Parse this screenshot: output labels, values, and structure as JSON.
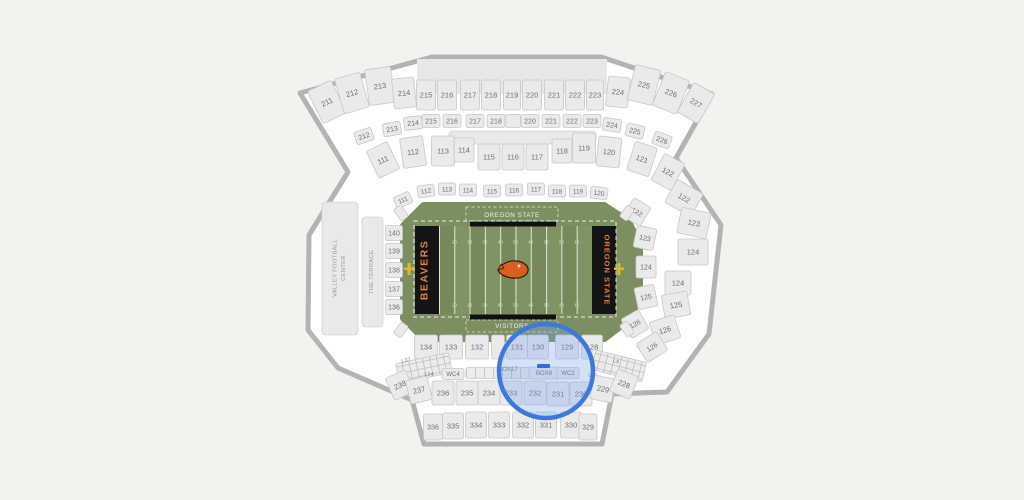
{
  "canvas": {
    "width": 1024,
    "height": 500
  },
  "colors": {
    "page_bg": "#f2f2ef",
    "bowl_bg": "#ffffff",
    "outline": "#b3b3b3",
    "section_fill": "#eaeaea",
    "section_stroke": "#c7c7c7",
    "section_text": "#6e6e6e",
    "structure_fill": "#e9e9e8",
    "apron_green": "#7b8f60",
    "field_green_dark": "#75895b",
    "field_green_light": "#7f9364",
    "endzone_black": "#141414",
    "osu_orange": "#e8813a",
    "logo_orange": "#d85f1d",
    "goalpost_yellow": "#dcb732",
    "highlight_stroke": "#3c78dd",
    "highlight_fill": "rgba(120,165,235,0.32)",
    "marker_blue": "#2e6fe0"
  },
  "field": {
    "sideline_home": "OREGON STATE",
    "sideline_visitors": "VISITORS",
    "endzone_west": "BEAVERS",
    "endzone_east": "OREGON STATE",
    "yard_numbers": [
      "10",
      "20",
      "30",
      "40",
      "50",
      "40",
      "30",
      "20",
      "10"
    ]
  },
  "venues": {
    "vfc_line1": "VALLEY FOOTBALL",
    "vfc_line2": "CENTER",
    "terrace": "THE TERRACE"
  },
  "highlight": {
    "cx": 546,
    "cy": 371,
    "r": 47,
    "stroke": "#3c78dd",
    "fill": "rgba(120,165,235,0.32)",
    "marker_fill": "#2e6fe0"
  },
  "sections": [
    {
      "t": "seat",
      "l": "211",
      "x": 327,
      "y": 102,
      "w": 26,
      "h": 36,
      "r": -26
    },
    {
      "t": "seat",
      "l": "212",
      "x": 352,
      "y": 93,
      "w": 26,
      "h": 36,
      "r": -16
    },
    {
      "t": "seat",
      "l": "213",
      "x": 380,
      "y": 86,
      "w": 26,
      "h": 36,
      "r": -8
    },
    {
      "t": "seat",
      "l": "214",
      "x": 404,
      "y": 93,
      "w": 22,
      "h": 30,
      "r": -6
    },
    {
      "t": "seat",
      "l": "215",
      "x": 426,
      "y": 95,
      "w": 19,
      "h": 30
    },
    {
      "t": "seat",
      "l": "216",
      "x": 447,
      "y": 95,
      "w": 19,
      "h": 30
    },
    {
      "t": "seat",
      "l": "217",
      "x": 470,
      "y": 95,
      "w": 19,
      "h": 30
    },
    {
      "t": "seat",
      "l": "218",
      "x": 491,
      "y": 95,
      "w": 19,
      "h": 30
    },
    {
      "t": "seat",
      "l": "219",
      "x": 512,
      "y": 95,
      "w": 17,
      "h": 30
    },
    {
      "t": "seat",
      "l": "220",
      "x": 532,
      "y": 95,
      "w": 19,
      "h": 30
    },
    {
      "t": "seat",
      "l": "221",
      "x": 554,
      "y": 95,
      "w": 19,
      "h": 30
    },
    {
      "t": "seat",
      "l": "222",
      "x": 575,
      "y": 95,
      "w": 19,
      "h": 30
    },
    {
      "t": "seat",
      "l": "223",
      "x": 595,
      "y": 95,
      "w": 17,
      "h": 30
    },
    {
      "t": "seat",
      "l": "224",
      "x": 618,
      "y": 92,
      "w": 22,
      "h": 30,
      "r": 6
    },
    {
      "t": "seat",
      "l": "225",
      "x": 644,
      "y": 85,
      "w": 26,
      "h": 36,
      "r": 14
    },
    {
      "t": "seat",
      "l": "226",
      "x": 671,
      "y": 93,
      "w": 26,
      "h": 36,
      "r": 22
    },
    {
      "t": "seat",
      "l": "227",
      "x": 696,
      "y": 103,
      "w": 24,
      "h": 34,
      "r": 30
    },
    {
      "t": "seat",
      "l": "212",
      "x": 364,
      "y": 136,
      "w": 18,
      "h": 13,
      "r": -18,
      "fs": 7
    },
    {
      "t": "seat",
      "l": "213",
      "x": 392,
      "y": 129,
      "w": 18,
      "h": 13,
      "r": -10,
      "fs": 7
    },
    {
      "t": "seat",
      "l": "214",
      "x": 413,
      "y": 123,
      "w": 18,
      "h": 13,
      "r": -6,
      "fs": 7
    },
    {
      "t": "seat",
      "l": "215",
      "x": 431,
      "y": 121,
      "w": 18,
      "h": 13,
      "fs": 7
    },
    {
      "t": "seat",
      "l": "216",
      "x": 452,
      "y": 121,
      "w": 18,
      "h": 13,
      "fs": 7
    },
    {
      "t": "seat",
      "l": "217",
      "x": 475,
      "y": 121,
      "w": 18,
      "h": 13,
      "fs": 7
    },
    {
      "t": "seat",
      "l": "218",
      "x": 496,
      "y": 121,
      "w": 18,
      "h": 13,
      "fs": 7
    },
    {
      "t": "blank",
      "x": 513,
      "y": 121,
      "w": 15,
      "h": 13
    },
    {
      "t": "seat",
      "l": "220",
      "x": 530,
      "y": 121,
      "w": 18,
      "h": 13,
      "fs": 7
    },
    {
      "t": "seat",
      "l": "221",
      "x": 551,
      "y": 121,
      "w": 18,
      "h": 13,
      "fs": 7
    },
    {
      "t": "seat",
      "l": "222",
      "x": 572,
      "y": 121,
      "w": 18,
      "h": 13,
      "fs": 7
    },
    {
      "t": "seat",
      "l": "223",
      "x": 592,
      "y": 121,
      "w": 18,
      "h": 13,
      "fs": 7
    },
    {
      "t": "seat",
      "l": "224",
      "x": 612,
      "y": 125,
      "w": 18,
      "h": 13,
      "r": 8,
      "fs": 7
    },
    {
      "t": "seat",
      "l": "225",
      "x": 635,
      "y": 131,
      "w": 18,
      "h": 13,
      "r": 14,
      "fs": 7
    },
    {
      "t": "seat",
      "l": "226",
      "x": 662,
      "y": 140,
      "w": 18,
      "h": 13,
      "r": 20,
      "fs": 7
    },
    {
      "t": "seat",
      "l": "111",
      "x": 383,
      "y": 160,
      "w": 23,
      "h": 30,
      "r": -26
    },
    {
      "t": "seat",
      "l": "112",
      "x": 413,
      "y": 152,
      "w": 23,
      "h": 30,
      "r": -8
    },
    {
      "t": "seat",
      "l": "113",
      "x": 443,
      "y": 151,
      "w": 23,
      "h": 30
    },
    {
      "t": "seat",
      "l": "114",
      "x": 464,
      "y": 150,
      "w": 20,
      "h": 24
    },
    {
      "t": "seat",
      "l": "115",
      "x": 489,
      "y": 157,
      "w": 22,
      "h": 26
    },
    {
      "t": "seat",
      "l": "116",
      "x": 513,
      "y": 157,
      "w": 22,
      "h": 26
    },
    {
      "t": "seat",
      "l": "117",
      "x": 537,
      "y": 157,
      "w": 22,
      "h": 26
    },
    {
      "t": "seat",
      "l": "118",
      "x": 562,
      "y": 151,
      "w": 20,
      "h": 24
    },
    {
      "t": "seat",
      "l": "119",
      "x": 584,
      "y": 148,
      "w": 23,
      "h": 30
    },
    {
      "t": "seat",
      "l": "120",
      "x": 609,
      "y": 152,
      "w": 23,
      "h": 30,
      "r": 6
    },
    {
      "t": "seat",
      "l": "121",
      "x": 642,
      "y": 159,
      "w": 23,
      "h": 30,
      "r": 18
    },
    {
      "t": "seat",
      "l": "122",
      "x": 668,
      "y": 172,
      "w": 23,
      "h": 30,
      "r": 28
    },
    {
      "t": "seat",
      "l": "111",
      "x": 403,
      "y": 200,
      "w": 17,
      "h": 12,
      "r": -24,
      "fs": 6.5
    },
    {
      "t": "seat",
      "l": "112",
      "x": 426,
      "y": 191,
      "w": 17,
      "h": 12,
      "r": -8,
      "fs": 6.5
    },
    {
      "t": "seat",
      "l": "113",
      "x": 447,
      "y": 189,
      "w": 17,
      "h": 12,
      "fs": 6.5
    },
    {
      "t": "seat",
      "l": "114",
      "x": 468,
      "y": 190,
      "w": 17,
      "h": 12,
      "fs": 6.5
    },
    {
      "t": "seat",
      "l": "115",
      "x": 492,
      "y": 191,
      "w": 17,
      "h": 12,
      "fs": 6.5
    },
    {
      "t": "seat",
      "l": "116",
      "x": 514,
      "y": 190,
      "w": 17,
      "h": 12,
      "fs": 6.5
    },
    {
      "t": "seat",
      "l": "117",
      "x": 536,
      "y": 189,
      "w": 17,
      "h": 12,
      "fs": 6.5
    },
    {
      "t": "seat",
      "l": "118",
      "x": 557,
      "y": 191,
      "w": 17,
      "h": 12,
      "fs": 6.5
    },
    {
      "t": "seat",
      "l": "119",
      "x": 578,
      "y": 191,
      "w": 17,
      "h": 12,
      "fs": 6.5
    },
    {
      "t": "seat",
      "l": "120",
      "x": 599,
      "y": 193,
      "w": 17,
      "h": 12,
      "r": 8,
      "fs": 6.5
    },
    {
      "t": "seat",
      "l": "122",
      "x": 637,
      "y": 212,
      "w": 20,
      "h": 22,
      "r": 32,
      "fs": 7
    },
    {
      "t": "seat",
      "l": "123",
      "x": 645,
      "y": 238,
      "w": 20,
      "h": 22,
      "r": 12,
      "fs": 7
    },
    {
      "t": "seat",
      "l": "124",
      "x": 646,
      "y": 267,
      "w": 20,
      "h": 22,
      "fs": 7
    },
    {
      "t": "seat",
      "l": "125",
      "x": 646,
      "y": 297,
      "w": 20,
      "h": 22,
      "r": -12,
      "fs": 7
    },
    {
      "t": "seat",
      "l": "126",
      "x": 635,
      "y": 324,
      "w": 20,
      "h": 22,
      "r": -30,
      "fs": 7
    },
    {
      "t": "seat",
      "l": "122",
      "x": 684,
      "y": 198,
      "w": 30,
      "h": 26,
      "r": 30
    },
    {
      "t": "seat",
      "l": "123",
      "x": 694,
      "y": 223,
      "w": 30,
      "h": 26,
      "r": 12
    },
    {
      "t": "seat",
      "l": "124",
      "x": 693,
      "y": 252,
      "w": 30,
      "h": 26
    },
    {
      "t": "seat",
      "l": "124",
      "x": 678,
      "y": 283,
      "w": 26,
      "h": 24
    },
    {
      "t": "seat",
      "l": "125",
      "x": 676,
      "y": 305,
      "w": 26,
      "h": 24,
      "r": -10
    },
    {
      "t": "seat",
      "l": "126",
      "x": 665,
      "y": 330,
      "w": 26,
      "h": 24,
      "r": -18
    },
    {
      "t": "seat",
      "l": "126",
      "x": 652,
      "y": 347,
      "w": 24,
      "h": 22,
      "r": -32,
      "fs": 7
    },
    {
      "t": "seat",
      "l": "140",
      "x": 394,
      "y": 233,
      "w": 17,
      "h": 15,
      "fs": 7
    },
    {
      "t": "seat",
      "l": "139",
      "x": 394,
      "y": 251,
      "w": 17,
      "h": 15,
      "fs": 7
    },
    {
      "t": "seat",
      "l": "138",
      "x": 394,
      "y": 270,
      "w": 17,
      "h": 15,
      "fs": 7
    },
    {
      "t": "seat",
      "l": "137",
      "x": 394,
      "y": 289,
      "w": 17,
      "h": 15,
      "fs": 7
    },
    {
      "t": "seat",
      "l": "136",
      "x": 394,
      "y": 307,
      "w": 17,
      "h": 15,
      "fs": 7
    },
    {
      "t": "blank",
      "x": 401,
      "y": 213,
      "w": 9,
      "h": 14,
      "r": -35
    },
    {
      "t": "blank",
      "x": 401,
      "y": 330,
      "w": 9,
      "h": 14,
      "r": 35
    },
    {
      "t": "blank",
      "x": 627,
      "y": 213,
      "w": 9,
      "h": 14,
      "r": 35
    },
    {
      "t": "blank",
      "x": 627,
      "y": 329,
      "w": 9,
      "h": 14,
      "r": -35
    },
    {
      "t": "seat",
      "l": "134",
      "x": 426,
      "y": 347,
      "w": 23,
      "h": 24
    },
    {
      "t": "seat",
      "l": "133",
      "x": 451,
      "y": 347,
      "w": 23,
      "h": 24
    },
    {
      "t": "seat",
      "l": "132",
      "x": 477,
      "y": 347,
      "w": 23,
      "h": 24
    },
    {
      "t": "blank",
      "x": 498,
      "y": 347,
      "w": 13,
      "h": 24
    },
    {
      "t": "seat",
      "l": "131",
      "x": 517,
      "y": 347,
      "w": 21,
      "h": 24
    },
    {
      "t": "seat",
      "l": "130",
      "x": 538,
      "y": 347,
      "w": 21,
      "h": 24
    },
    {
      "t": "seat",
      "l": "129",
      "x": 567,
      "y": 347,
      "w": 23,
      "h": 24
    },
    {
      "t": "seat",
      "l": "128",
      "x": 592,
      "y": 347,
      "w": 21,
      "h": 24
    },
    {
      "t": "hatch",
      "x": 424,
      "y": 368,
      "w": 54,
      "h": 20,
      "r": -12
    },
    {
      "t": "label",
      "l": "L37",
      "x": 406,
      "y": 360,
      "r": -12,
      "fs": 5.5
    },
    {
      "t": "label",
      "l": "L24",
      "x": 429,
      "y": 374,
      "fs": 5.5
    },
    {
      "t": "seat",
      "l": "WC4",
      "x": 453,
      "y": 374,
      "w": 22,
      "h": 11,
      "fs": 6
    },
    {
      "t": "cells",
      "x": 502,
      "y": 373,
      "w": 72,
      "h": 11
    },
    {
      "t": "label",
      "l": "BOX17",
      "x": 508,
      "y": 369,
      "fs": 6
    },
    {
      "t": "seat",
      "l": "BOX8",
      "x": 544,
      "y": 373,
      "w": 30,
      "h": 12,
      "fs": 6
    },
    {
      "t": "seat",
      "l": "WC2",
      "x": 568,
      "y": 373,
      "w": 22,
      "h": 11,
      "fs": 6
    },
    {
      "t": "label",
      "l": "L21",
      "x": 593,
      "y": 375,
      "fs": 5.5
    },
    {
      "t": "hatch",
      "x": 619,
      "y": 366,
      "w": 52,
      "h": 20,
      "r": 14
    },
    {
      "t": "label",
      "l": "L4",
      "x": 616,
      "y": 361,
      "r": 14,
      "fs": 5.5
    },
    {
      "t": "seat",
      "l": "238",
      "x": 400,
      "y": 385,
      "w": 22,
      "h": 24,
      "r": -24
    },
    {
      "t": "seat",
      "l": "237",
      "x": 419,
      "y": 390,
      "w": 22,
      "h": 24,
      "r": -14
    },
    {
      "t": "seat",
      "l": "236",
      "x": 443,
      "y": 393,
      "w": 22,
      "h": 24
    },
    {
      "t": "seat",
      "l": "235",
      "x": 467,
      "y": 393,
      "w": 22,
      "h": 24
    },
    {
      "t": "seat",
      "l": "234",
      "x": 489,
      "y": 393,
      "w": 22,
      "h": 24
    },
    {
      "t": "seat",
      "l": "233",
      "x": 511,
      "y": 393,
      "w": 22,
      "h": 24
    },
    {
      "t": "seat",
      "l": "232",
      "x": 535,
      "y": 393,
      "w": 22,
      "h": 24
    },
    {
      "t": "seat",
      "l": "231",
      "x": 558,
      "y": 394,
      "w": 22,
      "h": 24
    },
    {
      "t": "seat",
      "l": "230",
      "x": 581,
      "y": 394,
      "w": 22,
      "h": 24
    },
    {
      "t": "seat",
      "l": "229",
      "x": 603,
      "y": 389,
      "w": 22,
      "h": 24,
      "r": 12
    },
    {
      "t": "seat",
      "l": "228",
      "x": 624,
      "y": 384,
      "w": 22,
      "h": 24,
      "r": 22
    },
    {
      "t": "seat",
      "l": "336",
      "x": 433,
      "y": 427,
      "w": 19,
      "h": 26,
      "fs": 7
    },
    {
      "t": "seat",
      "l": "335",
      "x": 453,
      "y": 426,
      "w": 21,
      "h": 26
    },
    {
      "t": "seat",
      "l": "334",
      "x": 476,
      "y": 425,
      "w": 21,
      "h": 26
    },
    {
      "t": "seat",
      "l": "333",
      "x": 499,
      "y": 425,
      "w": 21,
      "h": 26
    },
    {
      "t": "seat",
      "l": "332",
      "x": 523,
      "y": 425,
      "w": 21,
      "h": 26
    },
    {
      "t": "seat",
      "l": "331",
      "x": 546,
      "y": 425,
      "w": 21,
      "h": 26
    },
    {
      "t": "seat",
      "l": "330",
      "x": 571,
      "y": 425,
      "w": 21,
      "h": 26
    },
    {
      "t": "seat",
      "l": "329",
      "x": 588,
      "y": 427,
      "w": 18,
      "h": 26,
      "fs": 7
    }
  ]
}
